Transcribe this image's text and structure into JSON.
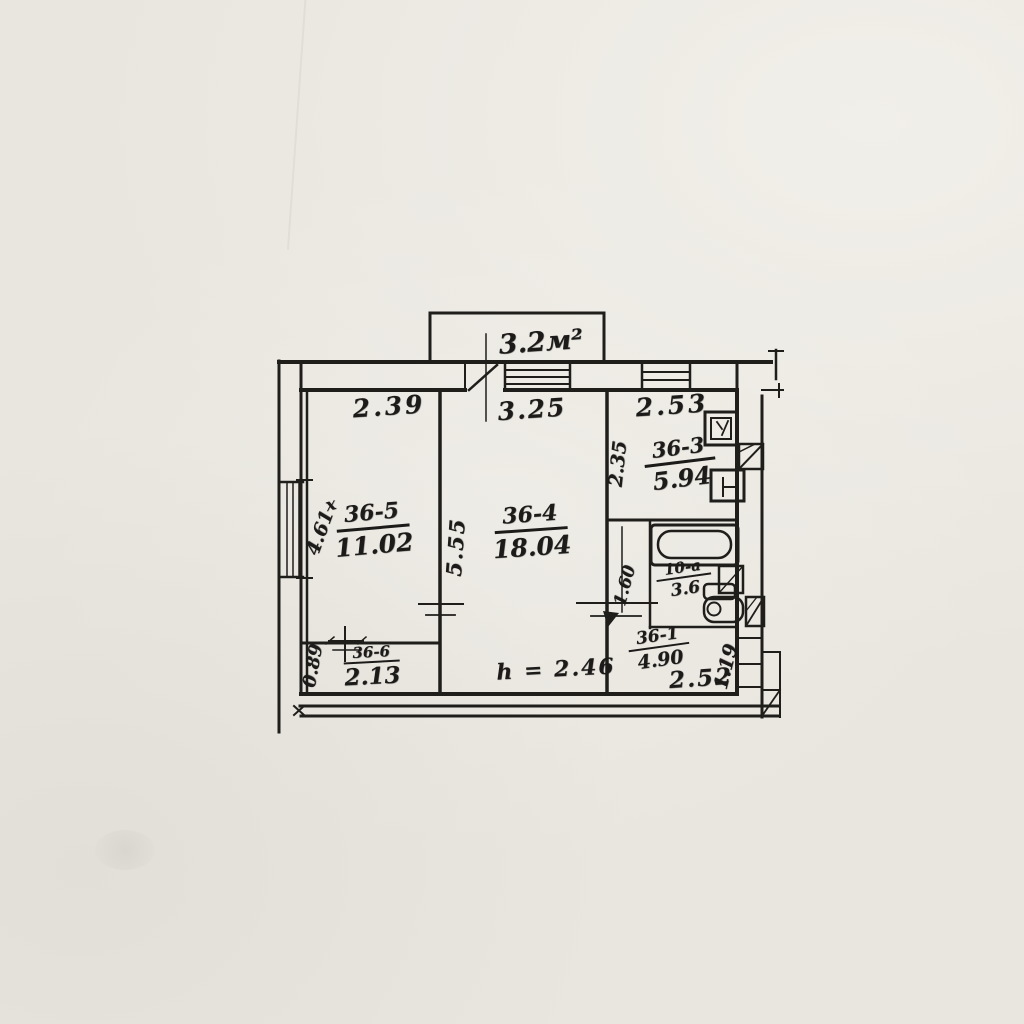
{
  "palette": {
    "paper": "#e9e6df",
    "ink": "#1c1b19"
  },
  "balcony": {
    "area_label": "3.2м²"
  },
  "dimensions_top": [
    "2.39",
    "3.25",
    "2.53"
  ],
  "rooms": {
    "room5": {
      "prefix": "х",
      "label": "36-5",
      "area": "11.02",
      "depth": "4.61"
    },
    "room4": {
      "label": "36-4",
      "area": "18.04",
      "depth": "5.55"
    },
    "kitchen": {
      "label": "36-3",
      "area": "5.94",
      "depth": "2.35"
    },
    "bath": {
      "label": "10-а",
      "area": "3.6",
      "width": "1.60"
    },
    "hall": {
      "label": "36-1",
      "area": "4.90",
      "width_dim": "2.52",
      "depth": "1.19"
    },
    "closet": {
      "label": "36-6",
      "area": "2.13",
      "depth": "0.89"
    }
  },
  "notes": {
    "ceiling_height": "h = 2.46"
  }
}
